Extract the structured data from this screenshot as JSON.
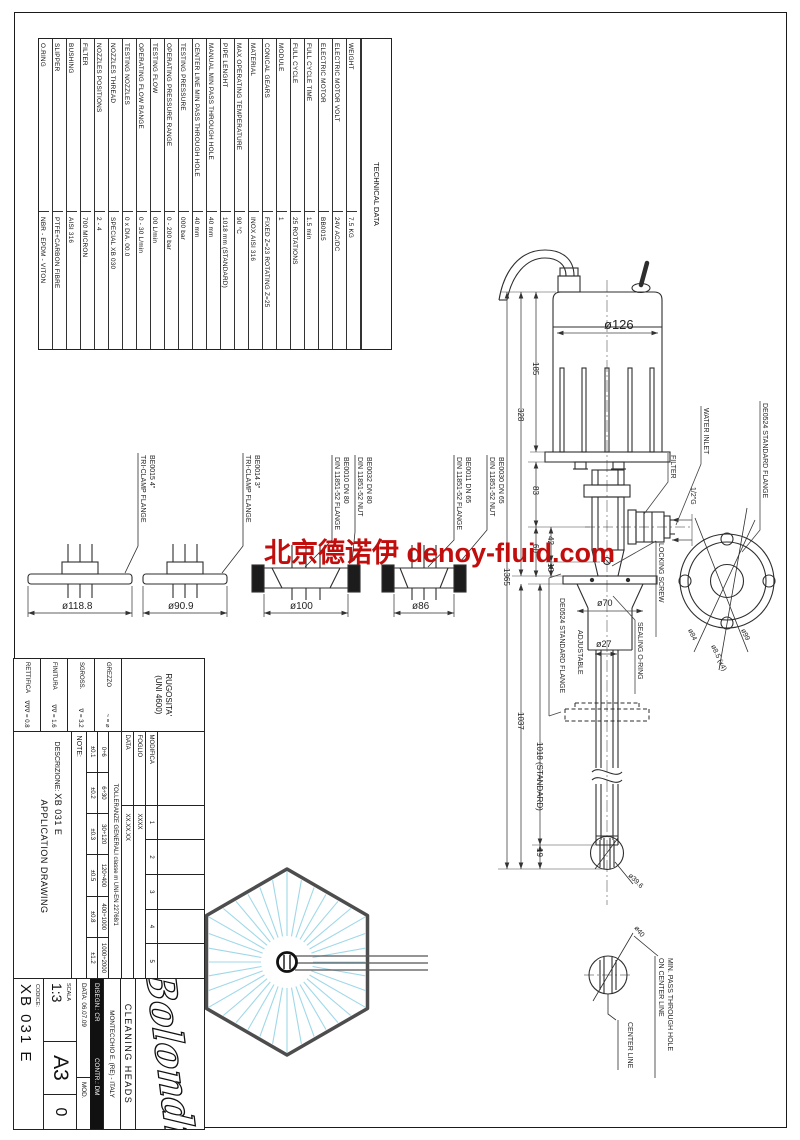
{
  "watermark": {
    "text": "北京德诺伊 denoy-fluid.com",
    "color": "#c20d0d"
  },
  "technical_table": {
    "header": "TECHNICAL DATA",
    "rows": [
      {
        "label": "O.RING",
        "value": "NBR - EPDM - VITON"
      },
      {
        "label": "SLIPPER",
        "value": "PTFE+CARBON FIBRE"
      },
      {
        "label": "BUSHING",
        "value": "AISI 316"
      },
      {
        "label": "FILTER",
        "value": "700 MICRON"
      },
      {
        "label": "NOZZLES POSITIONS",
        "value": "2 - 4"
      },
      {
        "label": "NOZZLES THREAD",
        "value": "SPECIAL XB 030"
      },
      {
        "label": "TESTING NOZZLES",
        "value": "0 x DIA. 00.0"
      },
      {
        "label": "OPERATING FLOW RANGE",
        "value": "0 - 30 L/min"
      },
      {
        "label": "TESTING FLOW",
        "value": "00 L/min"
      },
      {
        "label": "OPERATING PRESSURE RANGE",
        "value": "0 - 200 bar"
      },
      {
        "label": "TESTING PRESSURE",
        "value": "000 bar"
      },
      {
        "label": "CENTER LINE MIN PASS THROUGH HOLE",
        "value": "40 mm"
      },
      {
        "label": "MANUAL MIN PASS THROUGH HOLE",
        "value": "40 mm"
      },
      {
        "label": "PIPE LENGHT",
        "value": "1018 mm (STANDARD)"
      },
      {
        "label": "MAX OPERATING TEMPERATURE",
        "value": "90 °C"
      },
      {
        "label": "MATERIAL",
        "value": "INOX AISI 316"
      },
      {
        "label": "CONICAL GEARS",
        "value": "FIXED Z=23 ROTATING Z=25"
      },
      {
        "label": "MODULE",
        "value": "1"
      },
      {
        "label": "FULL CYCLE",
        "value": "25 ROTATIONS"
      },
      {
        "label": "FULL CYCLE TIME",
        "value": "1.5 min"
      },
      {
        "label": "ELECTRIC MOTOR",
        "value": "BB0015"
      },
      {
        "label": "ELECTRIC MOTOR VOLT",
        "value": "24V AC/DC"
      },
      {
        "label": "WEIGHT",
        "value": "7.5 KG"
      }
    ]
  },
  "flanges": {
    "f1": {
      "line1": "BE0015 4\"",
      "line2": "TRI-CLAMP FLANGE",
      "dim": "ø118.8"
    },
    "f2": {
      "line1": "BE0014 3\"",
      "line2": "TRI-CLAMP FLANGE",
      "dim": "ø90.9"
    },
    "f3a": {
      "line1": "BE0010 DN 80",
      "line2": "DIN 11851-52 FLANGE"
    },
    "f3b": {
      "line1": "BE0032 DN 80",
      "line2": "DIN 11851-52 NUT"
    },
    "f3_dim": "ø100",
    "f4a": {
      "line1": "BE0011 DN 65",
      "line2": "DIN 11851-52 FLANGE"
    },
    "f4b": {
      "line1": "BE0030 DN 65",
      "line2": "DIN 11851-52 NUT"
    },
    "f4_dim": "ø86"
  },
  "main_view": {
    "dims": {
      "d126": "ø126",
      "d185": "185",
      "d328": "328",
      "d83": "83",
      "d60": "60",
      "d42": "42",
      "d18": "18",
      "d1365": "1365",
      "d1037": "1037",
      "d1018": "1018 (STANDARD)",
      "d19": "19",
      "d70": "ø70",
      "d27": "ø27",
      "d396": "ø39.6"
    },
    "labels": {
      "water_inlet": "WATER INLET",
      "filter": "FILTER",
      "thread": "1/2\"G",
      "flange_std": "DE0524 STANDARD FLANGE",
      "locking": "LOCKING SCREW",
      "sealing": "SEALING O-RING",
      "flange_adj": "DE0524 STANDARD FLANGE",
      "adjustable": "ADJUSTABLE"
    },
    "flange_view": {
      "d84": "ø84",
      "d85": "ø8.5 (x4)",
      "d99": "ø99"
    }
  },
  "detail": {
    "d40": "ø40",
    "line1": "MIN. PASS THROUGH HOLE",
    "line2": "ON CENTER LINE",
    "center_line": "CENTER LINE"
  },
  "title_block": {
    "rugosita_1": "RUGOSITA'",
    "rugosita_2": "(UNI 4600)",
    "roughness": [
      {
        "label": "GREZZO",
        "value": "~ = ⌀"
      },
      {
        "label": "SGROSS.",
        "value": "∇ = 3.2"
      },
      {
        "label": "FINITURA",
        "value": "∇∇ = 1.6"
      },
      {
        "label": "RETTIFICA",
        "value": "∇∇∇ = 0.8"
      }
    ],
    "revisions": {
      "modifica": "MODIFICA",
      "foglio": "FOGLIO",
      "data": "DATA",
      "cols": [
        "1",
        "2",
        "3",
        "4",
        "5"
      ],
      "foglio_value": "XXXX",
      "data_value": "XX.XX.XX"
    },
    "tolerances": {
      "title": "TOLLERANZE GENERALI classe m UNI-EN 22768/1",
      "ranges": [
        "0÷6",
        "6÷30",
        "30÷120",
        "120÷400",
        "400÷1000",
        "1000÷2000"
      ],
      "values": [
        "±0.1",
        "±0.2",
        "±0.3",
        "±0.5",
        "±0.8",
        "±1.2"
      ]
    },
    "note": "NOTE:",
    "descrizione_label": "DESCRIZIONE:",
    "descrizione_value": "XB 031 E",
    "descrizione_line2": "APPLICATION DRAWING",
    "logo": "Bolondi",
    "company_line1": "CLEANING HEADS",
    "company_line2": "MONTECCHIO E. (RE) - ITALY",
    "disegn": "DISEGN.: CR",
    "contr": "CONTR.: DM",
    "data_label": "DATA: 06.07.09",
    "mod_label": "MOD.",
    "mod_value": "0",
    "scala_label": "SCALA",
    "scala_value": "1:3",
    "format": "A3",
    "codice_label": "CODICE:",
    "codice_value": "XB 031 E"
  }
}
